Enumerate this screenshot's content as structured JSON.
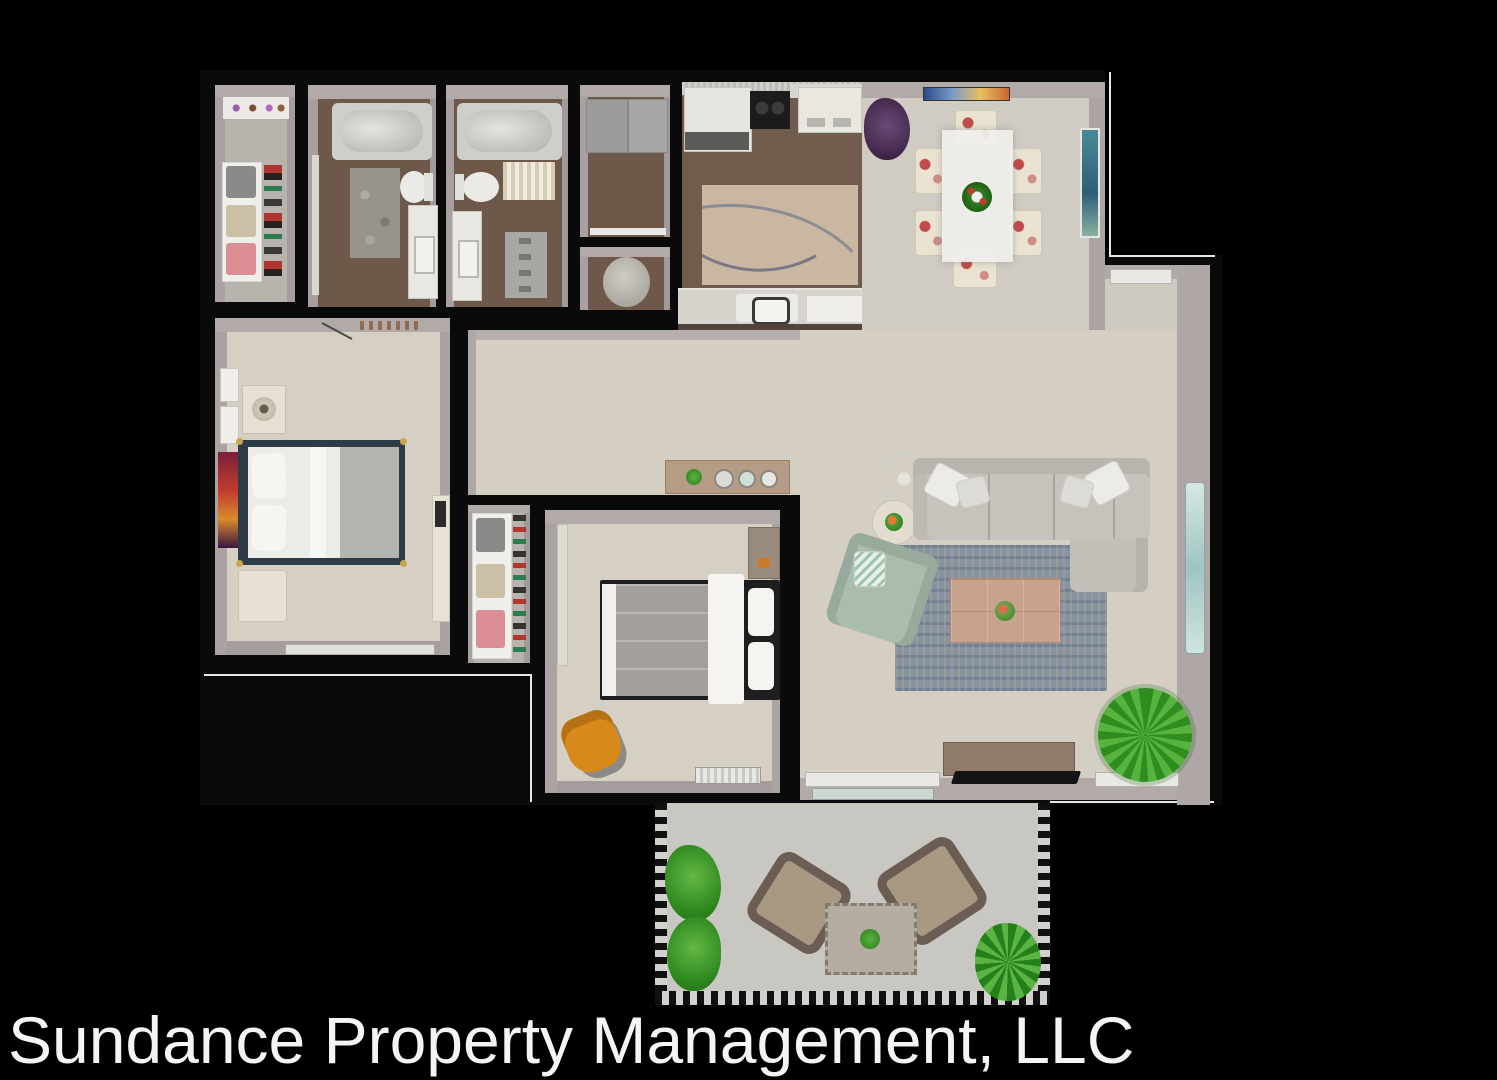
{
  "footer": {
    "text": "Sundance Property Management, LLC"
  },
  "palette": {
    "background": "#000000",
    "walls": "#0a0a0a",
    "wall_face": "#b2a9a9",
    "carpet": "#d6d0c4",
    "closet_carpet": "#b8b3ac",
    "wood_floor": "#6e5849",
    "dining_tile": "#d0ccc3",
    "patio_concrete": "#c8c7c2",
    "sofa": "#c7c2bc",
    "armchair_green": "#a9bcae",
    "living_rug": "#8793a0",
    "kitchen_rug": "#c9b7a2",
    "coffee_table": "#c9a28d",
    "master_bed_frame": "#2e3c49",
    "bed_linens": "#ecebe7",
    "orange_chair": "#d8891c",
    "plant_green": "#3c9427",
    "plant_purple": "#4a2d52",
    "dining_chair": "#eae3d2",
    "dining_chair_pattern": "#c14b4a",
    "mirror_teal": "#bcd8d4",
    "footer_text_color": "#f4f4f4"
  },
  "plan": {
    "type": "apartment-floor-plan-3d-top-view",
    "rooms": [
      {
        "name": "walk-in-closet",
        "furniture": [
          "display-shelf",
          "shelving-unit-with-folded-clothes",
          "hanging-clothes"
        ]
      },
      {
        "name": "bathroom-1",
        "furniture": [
          "bathtub",
          "toilet",
          "vanity-sink",
          "patterned-rug",
          "door"
        ]
      },
      {
        "name": "bathroom-2",
        "furniture": [
          "bathtub",
          "toilet",
          "vanity-sink",
          "striped-rug",
          "bath-mat",
          "door"
        ]
      },
      {
        "name": "laundry-closet",
        "furniture": [
          "washer",
          "dryer",
          "shelf"
        ]
      },
      {
        "name": "water-closet",
        "furniture": [
          "toilet"
        ]
      },
      {
        "name": "kitchen",
        "furniture": [
          "upper-cabinets",
          "refrigerator",
          "cooktop",
          "island-cart",
          "kitchen-rug",
          "sink",
          "counter-peninsula"
        ]
      },
      {
        "name": "dining-area",
        "furniture": [
          "dining-table",
          "dining-chairs-x6",
          "centerpiece-wreath",
          "wall-art",
          "purple-potted-plant",
          "framed-painting"
        ]
      },
      {
        "name": "entry",
        "furniture": [
          "front-door"
        ]
      },
      {
        "name": "hallway",
        "furniture": [
          "console-table"
        ]
      },
      {
        "name": "master-bedroom",
        "furniture": [
          "double-bed",
          "nightstand-with-lamp",
          "bench",
          "dresser-with-tv",
          "red-wall-art",
          "white-wall-frames",
          "window",
          "door"
        ]
      },
      {
        "name": "hall-closet",
        "furniture": [
          "shelving-unit-with-folded-clothes",
          "shoe-rack"
        ]
      },
      {
        "name": "bedroom-2",
        "furniture": [
          "double-bed",
          "nightstand",
          "orange-chair",
          "closet",
          "baseboard-heater"
        ]
      },
      {
        "name": "living-room",
        "furniture": [
          "sectional-sofa",
          "throw-pillows",
          "green-armchair",
          "round-glass-table",
          "side-table-with-plant",
          "area-rug",
          "coffee-table",
          "tv-console",
          "tv",
          "floor-plant",
          "wall-mirror",
          "window",
          "window"
        ]
      },
      {
        "name": "patio",
        "furniture": [
          "lounge-chair",
          "lounge-chair",
          "outdoor-table-with-plant",
          "planter-shrubs",
          "palm-plant",
          "railing"
        ]
      }
    ]
  }
}
